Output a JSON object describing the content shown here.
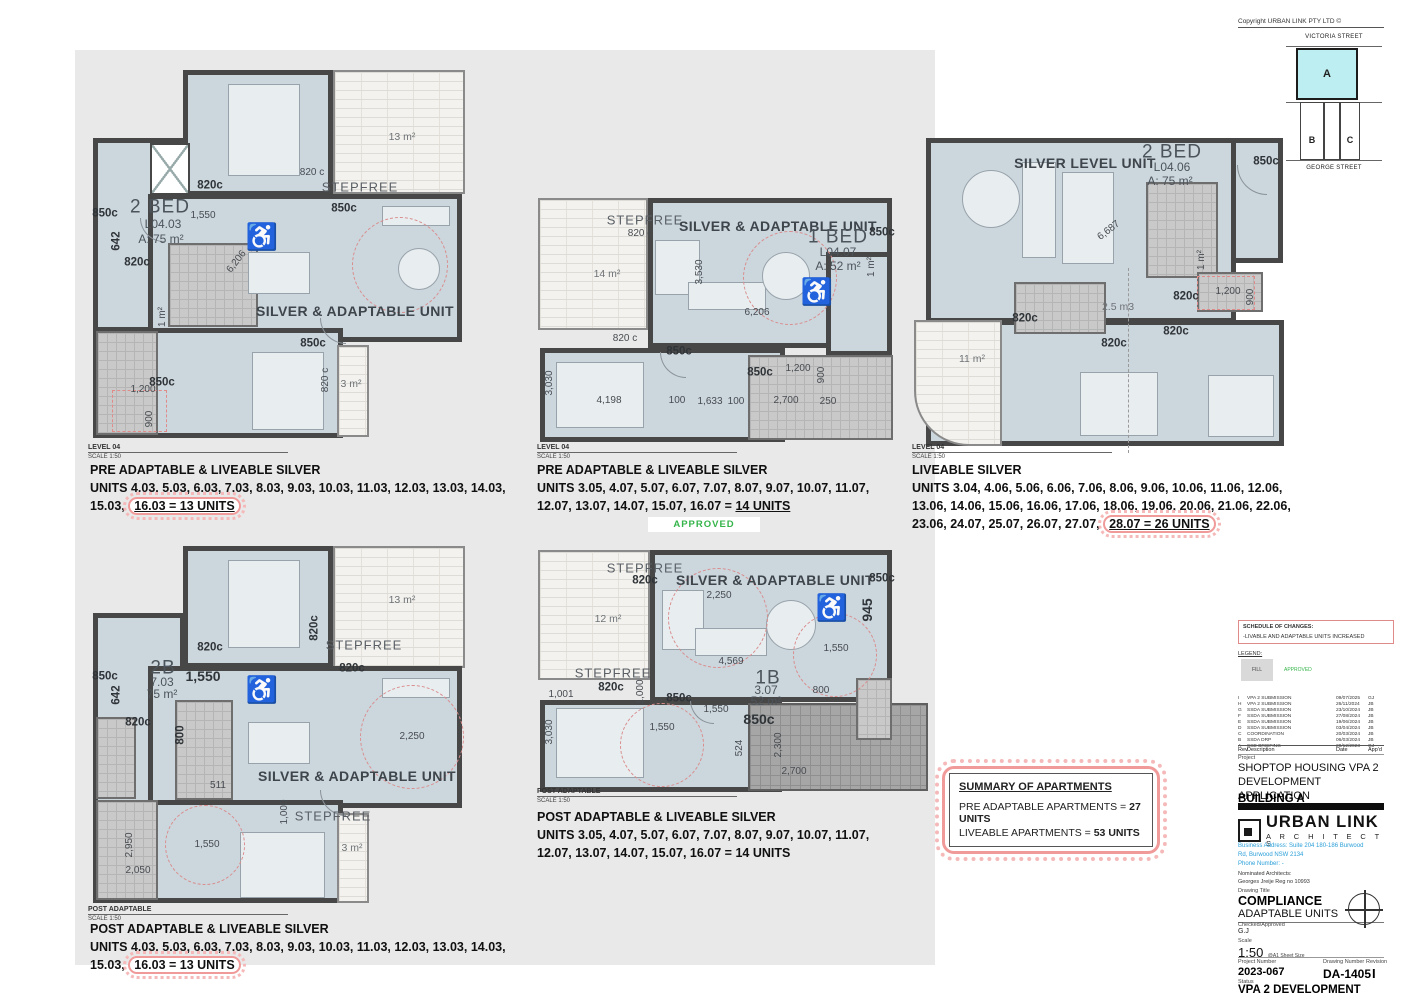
{
  "captions": [
    {
      "heading": "PRE ADAPTABLE & LIVEABLE SILVER",
      "units": "UNITS 4.03, 5.03, 6.03, 7.03, 8.03, 9.03, 10.03, 11.03, 12.03, 13.03, 14.03, 15.03,",
      "highlight": "16.03 = 13 UNITS",
      "cloud": true,
      "underline": true,
      "view_name": "LEVEL 04",
      "view_scale": "SCALE 1:50"
    },
    {
      "heading": "PRE ADAPTABLE & LIVEABLE SILVER",
      "units": "UNITS 3.05, 4.07, 5.07, 6.07, 7.07, 8.07, 9.07, 10.07, 11.07, 12.07, 13.07, 14.07, 15.07, 16.07 =",
      "highlight": "14 UNITS",
      "cloud": false,
      "underline": true,
      "view_name": "LEVEL 04",
      "view_scale": "SCALE 1:50"
    },
    {
      "heading": "LIVEABLE SILVER",
      "units": "UNITS 3.04, 4.06, 5.06, 6.06, 7.06, 8.06, 9.06, 10.06, 11.06, 12.06, 13.06, 14.06, 15.06, 16.06, 17.06, 18.06, 19.06, 20.06, 21.06, 22.06, 23.06, 24.07, 25.07, 26.07, 27.07,",
      "highlight": "28.07 = 26 UNITS",
      "cloud": true,
      "underline": true,
      "view_name": "LEVEL 04",
      "view_scale": "SCALE 1:50"
    },
    {
      "heading": "POST ADAPTABLE & LIVEABLE SILVER",
      "units": "UNITS 4.03, 5.03, 6.03, 7.03, 8.03, 9.03, 10.03, 11.03, 12.03, 13.03, 14.03, 15.03,",
      "highlight": "16.03 = 13 UNITS",
      "cloud": true,
      "underline": false,
      "view_name": "POST ADAPTABLE",
      "view_scale": "SCALE 1:50"
    },
    {
      "heading": "POST ADAPTABLE & LIVEABLE SILVER",
      "units": "UNITS 3.05, 4.07, 5.07, 6.07, 7.07, 8.07, 9.07, 10.07, 11.07, 12.07, 13.07, 14.07, 15.07, 16.07 =",
      "highlight": "14 UNITS",
      "cloud": false,
      "underline": false,
      "view_name": "POST ADAPTABLE",
      "view_scale": "SCALE 1:50"
    }
  ],
  "approved_stamp": "APPROVED",
  "summary": {
    "title": "SUMMARY OF APARTMENTS",
    "line1_pre": "PRE ADAPTABLE APARTMENTS = ",
    "line1_bold": "27 UNITS",
    "line2_pre": "LIVEABLE APARTMENTS = ",
    "line2_bold": "53 UNITS"
  },
  "key_map": {
    "street_top": "VICTORIA STREET",
    "street_bottom": "GEORGE STREET",
    "lot_a": "A",
    "lot_b": "B",
    "lot_c": "C",
    "highlight_color": "#bdeef2"
  },
  "title_block": {
    "copyright": "Copyright URBAN LINK PTY LTD ©",
    "schedule_title": "SCHEDULE OF CHANGES:",
    "schedule_item": "-LIVABLE AND ADAPTABLE UNITS INCREASED",
    "legend_label": "LEGEND:",
    "legend_fill": "FILL",
    "legend_approved": "APPROVED",
    "rev_header": {
      "rev": "Rev",
      "desc": "Description",
      "date": "Date",
      "appd": "App'd"
    },
    "revisions": [
      {
        "rev": "I",
        "desc": "VPA 2 SUBMISSION",
        "date": "09/07/2025",
        "appd": "GJ"
      },
      {
        "rev": "H",
        "desc": "VPA 2 SUBMISSION",
        "date": "26/11/2024",
        "appd": "JB"
      },
      {
        "rev": "G",
        "desc": "SSDA SUBMISSION",
        "date": "23/10/2024",
        "appd": "JB"
      },
      {
        "rev": "F",
        "desc": "SSDA SUBMISSION",
        "date": "27/08/2024",
        "appd": "JB"
      },
      {
        "rev": "E",
        "desc": "SSDA SUBMISSION",
        "date": "19/06/2024",
        "appd": "JB"
      },
      {
        "rev": "D",
        "desc": "SSDA SUBMISSION",
        "date": "03/04/2024",
        "appd": "JB"
      },
      {
        "rev": "C",
        "desc": "COORDINATION",
        "date": "20/03/2024",
        "appd": "JB"
      },
      {
        "rev": "B",
        "desc": "SSDA DRP",
        "date": "06/03/2024",
        "appd": "JB"
      },
      {
        "rev": "A",
        "desc": "SSD BRIEFING",
        "date": "20/12/2023",
        "appd": "GJ"
      }
    ],
    "project_label": "Project",
    "project_line1": "SHOPTOP HOUSING VPA 2",
    "project_line2": "DEVELOPMENT APPLICATION",
    "building": "BUILDING A",
    "firm_name": "URBAN LINK",
    "firm_sub": "A R C H I T E C T S",
    "address1": "Business Address: Suite 204 180-186 Burwood",
    "address2": "Rd,  Burwood NSW 2134",
    "address3": "Phone Number: -",
    "nominated": "Nominated Architects:",
    "architect": "Georges Jreije Reg no 10993",
    "drawing_title_label": "Drawing Title",
    "drawing_title": "COMPLIANCE",
    "drawing_subtitle": "ADAPTABLE UNITS",
    "checked_label": "Checked/Approved",
    "checked": "G.J",
    "scale_label": "Scale",
    "scale": "1:50",
    "scale_note": "@A1 Sheet Size",
    "project_number_label": "Project Number",
    "project_number": "2023-067",
    "drawing_number_label": "Drawing Number",
    "drawing_number": "DA-1405",
    "revision_label": "Revision",
    "revision": "I",
    "status_label": "Status",
    "status": "VPA 2 DEVELOPMENT APPLICATION",
    "fine_print": "Suite 204 180-186 Burwood Rd Burwood NSW 2134"
  },
  "wheelchairs": [
    {
      "x": 262,
      "y": 237
    },
    {
      "x": 817,
      "y": 292
    },
    {
      "x": 832,
      "y": 608
    },
    {
      "x": 262,
      "y": 690
    }
  ],
  "plan_labels": [
    {
      "t": "13 m²",
      "x": 402,
      "y": 137,
      "c": "balct"
    },
    {
      "t": "820 c",
      "x": 312,
      "y": 173,
      "c": "dim"
    },
    {
      "t": "STEPFREE",
      "x": 360,
      "y": 187,
      "c": "zone2"
    },
    {
      "t": "820c",
      "x": 210,
      "y": 186,
      "c": "dimb"
    },
    {
      "t": "850c",
      "x": 105,
      "y": 214,
      "c": "dimb"
    },
    {
      "t": "2 BED",
      "x": 160,
      "y": 207,
      "c": "room"
    },
    {
      "t": "L04.03",
      "x": 163,
      "y": 224,
      "c": "unit"
    },
    {
      "t": "A: 75 m²",
      "x": 161,
      "y": 239,
      "c": "unit"
    },
    {
      "t": "850c",
      "x": 344,
      "y": 209,
      "c": "dimb"
    },
    {
      "t": "1,550",
      "x": 203,
      "y": 216,
      "c": "dim"
    },
    {
      "t": "642",
      "x": 117,
      "y": 241,
      "c": "dimb",
      "r": -90
    },
    {
      "t": "820c",
      "x": 137,
      "y": 263,
      "c": "dimb"
    },
    {
      "t": "6,206",
      "x": 237,
      "y": 262,
      "c": "dim",
      "r": -52
    },
    {
      "t": "1 m²",
      "x": 163,
      "y": 317,
      "c": "dim",
      "r": -90
    },
    {
      "t": "SILVER & ADAPTABLE UNIT",
      "x": 355,
      "y": 311,
      "c": "zone"
    },
    {
      "t": "850c",
      "x": 313,
      "y": 344,
      "c": "dimb"
    },
    {
      "t": "850c",
      "x": 162,
      "y": 383,
      "c": "dimb"
    },
    {
      "t": "1,200",
      "x": 143,
      "y": 390,
      "c": "dim"
    },
    {
      "t": "900",
      "x": 150,
      "y": 419,
      "c": "dim",
      "r": -90
    },
    {
      "t": "820 c",
      "x": 326,
      "y": 380,
      "c": "dim",
      "r": -90
    },
    {
      "t": "3 m²",
      "x": 351,
      "y": 384,
      "c": "balct"
    },
    {
      "t": "STEPFREE",
      "x": 645,
      "y": 220,
      "c": "zone2"
    },
    {
      "t": "820 c",
      "x": 640,
      "y": 234,
      "c": "dim"
    },
    {
      "t": "SILVER & ADAPTABLE UNIT",
      "x": 778,
      "y": 226,
      "c": "zone"
    },
    {
      "t": "1 BED",
      "x": 838,
      "y": 237,
      "c": "room"
    },
    {
      "t": "L04.07",
      "x": 838,
      "y": 252,
      "c": "unit"
    },
    {
      "t": "A: 52 m²",
      "x": 838,
      "y": 266,
      "c": "unit"
    },
    {
      "t": "850c",
      "x": 882,
      "y": 233,
      "c": "dimb"
    },
    {
      "t": "14 m²",
      "x": 607,
      "y": 274,
      "c": "balct"
    },
    {
      "t": "3,530",
      "x": 700,
      "y": 272,
      "c": "dim",
      "r": -90
    },
    {
      "t": "6,206",
      "x": 757,
      "y": 313,
      "c": "dim"
    },
    {
      "t": "1 m²",
      "x": 872,
      "y": 267,
      "c": "dim",
      "r": -90
    },
    {
      "t": "820 c",
      "x": 625,
      "y": 339,
      "c": "dim"
    },
    {
      "t": "850c",
      "x": 679,
      "y": 352,
      "c": "dimb"
    },
    {
      "t": "850c",
      "x": 760,
      "y": 373,
      "c": "dimb"
    },
    {
      "t": "1,200",
      "x": 798,
      "y": 369,
      "c": "dim"
    },
    {
      "t": "900",
      "x": 822,
      "y": 375,
      "c": "dim",
      "r": -90
    },
    {
      "t": "3,030",
      "x": 550,
      "y": 383,
      "c": "dim",
      "r": -90
    },
    {
      "t": "4,198",
      "x": 609,
      "y": 401,
      "c": "dim"
    },
    {
      "t": "100",
      "x": 677,
      "y": 401,
      "c": "dim"
    },
    {
      "t": "1,633",
      "x": 710,
      "y": 402,
      "c": "dim"
    },
    {
      "t": "100",
      "x": 736,
      "y": 402,
      "c": "dim"
    },
    {
      "t": "2,700",
      "x": 786,
      "y": 401,
      "c": "dim"
    },
    {
      "t": "250",
      "x": 828,
      "y": 402,
      "c": "dim"
    },
    {
      "t": "SILVER LEVEL UNIT",
      "x": 1085,
      "y": 163,
      "c": "zone"
    },
    {
      "t": "2 BED",
      "x": 1172,
      "y": 152,
      "c": "room"
    },
    {
      "t": "L04.06",
      "x": 1172,
      "y": 167,
      "c": "unit"
    },
    {
      "t": "A: 75 m²",
      "x": 1170,
      "y": 181,
      "c": "unit"
    },
    {
      "t": "850c",
      "x": 1266,
      "y": 162,
      "c": "dimb"
    },
    {
      "t": "6,687",
      "x": 1109,
      "y": 231,
      "c": "dim",
      "r": -38
    },
    {
      "t": "1 m²",
      "x": 1202,
      "y": 260,
      "c": "dim",
      "r": -90
    },
    {
      "t": "2.5 m3",
      "x": 1118,
      "y": 307,
      "c": "balct"
    },
    {
      "t": "820c",
      "x": 1186,
      "y": 297,
      "c": "dimb"
    },
    {
      "t": "1,200",
      "x": 1228,
      "y": 292,
      "c": "dim"
    },
    {
      "t": "900",
      "x": 1251,
      "y": 297,
      "c": "dim",
      "r": -90
    },
    {
      "t": "820c",
      "x": 1025,
      "y": 319,
      "c": "dimb"
    },
    {
      "t": "820c",
      "x": 1114,
      "y": 344,
      "c": "dimb"
    },
    {
      "t": "820c",
      "x": 1176,
      "y": 332,
      "c": "dimb"
    },
    {
      "t": "11 m²",
      "x": 972,
      "y": 359,
      "c": "balct"
    },
    {
      "t": "13 m²",
      "x": 402,
      "y": 600,
      "c": "balct"
    },
    {
      "t": "820c",
      "x": 315,
      "y": 628,
      "c": "dimb",
      "r": -90
    },
    {
      "t": "STEPFREE",
      "x": 364,
      "y": 645,
      "c": "zone2"
    },
    {
      "t": "820c",
      "x": 352,
      "y": 669,
      "c": "dimb"
    },
    {
      "t": "820c",
      "x": 210,
      "y": 648,
      "c": "dimb"
    },
    {
      "t": "2B",
      "x": 163,
      "y": 668,
      "c": "room"
    },
    {
      "t": "7.03",
      "x": 162,
      "y": 682,
      "c": "unit"
    },
    {
      "t": "75 m²",
      "x": 162,
      "y": 694,
      "c": "unit"
    },
    {
      "t": "1,550",
      "x": 203,
      "y": 676,
      "c": "dimb2"
    },
    {
      "t": "850c",
      "x": 105,
      "y": 677,
      "c": "dimb"
    },
    {
      "t": "642",
      "x": 117,
      "y": 695,
      "c": "dimb",
      "r": -90
    },
    {
      "t": "820c",
      "x": 138,
      "y": 723,
      "c": "dimb"
    },
    {
      "t": "800",
      "x": 181,
      "y": 735,
      "c": "dimb",
      "r": -90
    },
    {
      "t": "511",
      "x": 218,
      "y": 786,
      "c": "dim"
    },
    {
      "t": "2,250",
      "x": 412,
      "y": 737,
      "c": "dim"
    },
    {
      "t": "SILVER & ADAPTABLE UNIT",
      "x": 357,
      "y": 776,
      "c": "zone"
    },
    {
      "t": "1,000",
      "x": 285,
      "y": 812,
      "c": "dim",
      "r": -90
    },
    {
      "t": "STEPFREE",
      "x": 333,
      "y": 816,
      "c": "zone2"
    },
    {
      "t": "3 m²",
      "x": 352,
      "y": 848,
      "c": "balct"
    },
    {
      "t": "1,550",
      "x": 207,
      "y": 845,
      "c": "dim"
    },
    {
      "t": "2,950",
      "x": 130,
      "y": 845,
      "c": "dim",
      "r": -90
    },
    {
      "t": "2,050",
      "x": 138,
      "y": 871,
      "c": "dim"
    },
    {
      "t": "STEPFREE",
      "x": 645,
      "y": 568,
      "c": "zone2"
    },
    {
      "t": "820c",
      "x": 645,
      "y": 581,
      "c": "dimb"
    },
    {
      "t": "SILVER & ADAPTABLE UNIT",
      "x": 775,
      "y": 580,
      "c": "zone"
    },
    {
      "t": "850c",
      "x": 882,
      "y": 579,
      "c": "dimb"
    },
    {
      "t": "2,250",
      "x": 719,
      "y": 596,
      "c": "dim"
    },
    {
      "t": "12 m²",
      "x": 608,
      "y": 619,
      "c": "balct"
    },
    {
      "t": "945",
      "x": 867,
      "y": 610,
      "c": "dimb2",
      "r": -90
    },
    {
      "t": "4,569",
      "x": 731,
      "y": 662,
      "c": "dim"
    },
    {
      "t": "1,550",
      "x": 836,
      "y": 649,
      "c": "dim"
    },
    {
      "t": "1B",
      "x": 768,
      "y": 678,
      "c": "room"
    },
    {
      "t": "3.07",
      "x": 766,
      "y": 690,
      "c": "unit"
    },
    {
      "t": "52 m²",
      "x": 766,
      "y": 701,
      "c": "unit"
    },
    {
      "t": "800",
      "x": 821,
      "y": 691,
      "c": "dim"
    },
    {
      "t": "STEPFREE",
      "x": 613,
      "y": 673,
      "c": "zone2"
    },
    {
      "t": "820c",
      "x": 611,
      "y": 688,
      "c": "dimb"
    },
    {
      "t": "1,001",
      "x": 561,
      "y": 695,
      "c": "dim"
    },
    {
      "t": "1,000",
      "x": 641,
      "y": 692,
      "c": "dim",
      "r": -90
    },
    {
      "t": "850c",
      "x": 679,
      "y": 699,
      "c": "dimb"
    },
    {
      "t": "1,550",
      "x": 716,
      "y": 710,
      "c": "dim"
    },
    {
      "t": "850c",
      "x": 759,
      "y": 719,
      "c": "dimb2"
    },
    {
      "t": "3,030",
      "x": 550,
      "y": 732,
      "c": "dim",
      "r": -90
    },
    {
      "t": "1,550",
      "x": 662,
      "y": 728,
      "c": "dim"
    },
    {
      "t": "524",
      "x": 740,
      "y": 748,
      "c": "dim",
      "r": -90
    },
    {
      "t": "2,300",
      "x": 779,
      "y": 745,
      "c": "dim",
      "r": -90
    },
    {
      "t": "2,700",
      "x": 794,
      "y": 772,
      "c": "dim"
    }
  ]
}
